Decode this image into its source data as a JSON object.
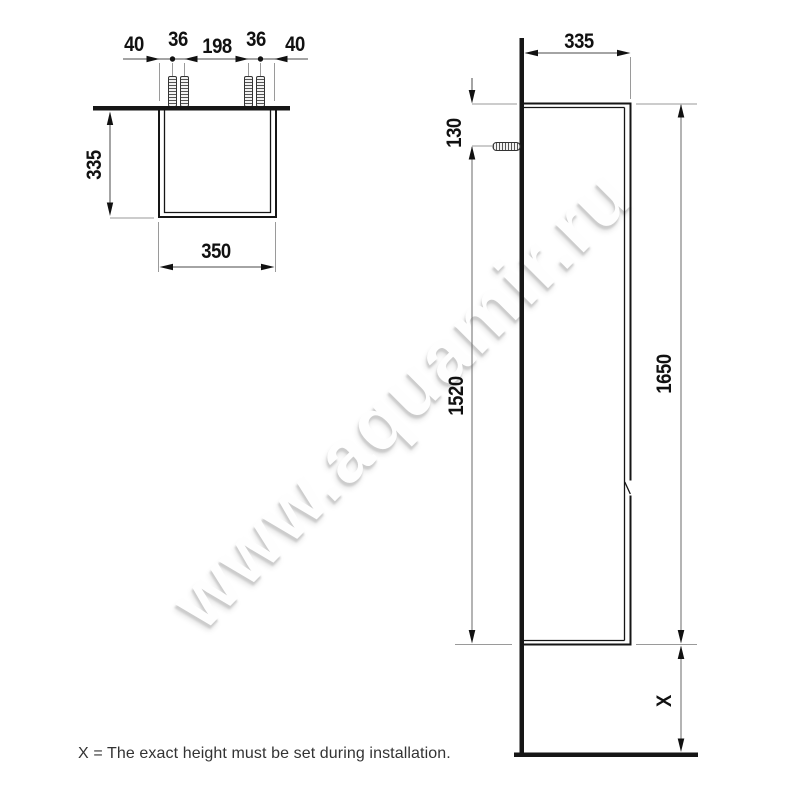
{
  "watermark": {
    "text": "www.aquamir.ru"
  },
  "note": {
    "text": "X = The exact height must be set during installation."
  },
  "colors": {
    "object_line": "#161616",
    "dimension_line": "#4a4a4a",
    "extension_line": "#9a9a9a",
    "label": "#111111",
    "watermark_shadow": "#cccccc"
  },
  "top_view": {
    "labels": {
      "spacing_left_outer": "40",
      "spacing_left_screws": "36",
      "spacing_center": "198",
      "spacing_right_screws": "36",
      "spacing_right_outer": "40",
      "depth": "335",
      "width": "350"
    }
  },
  "side_view": {
    "labels": {
      "depth": "335",
      "screw_top_offset": "130",
      "screw_to_bottom": "1520",
      "total_height": "1650",
      "floor_clearance": "X"
    }
  }
}
